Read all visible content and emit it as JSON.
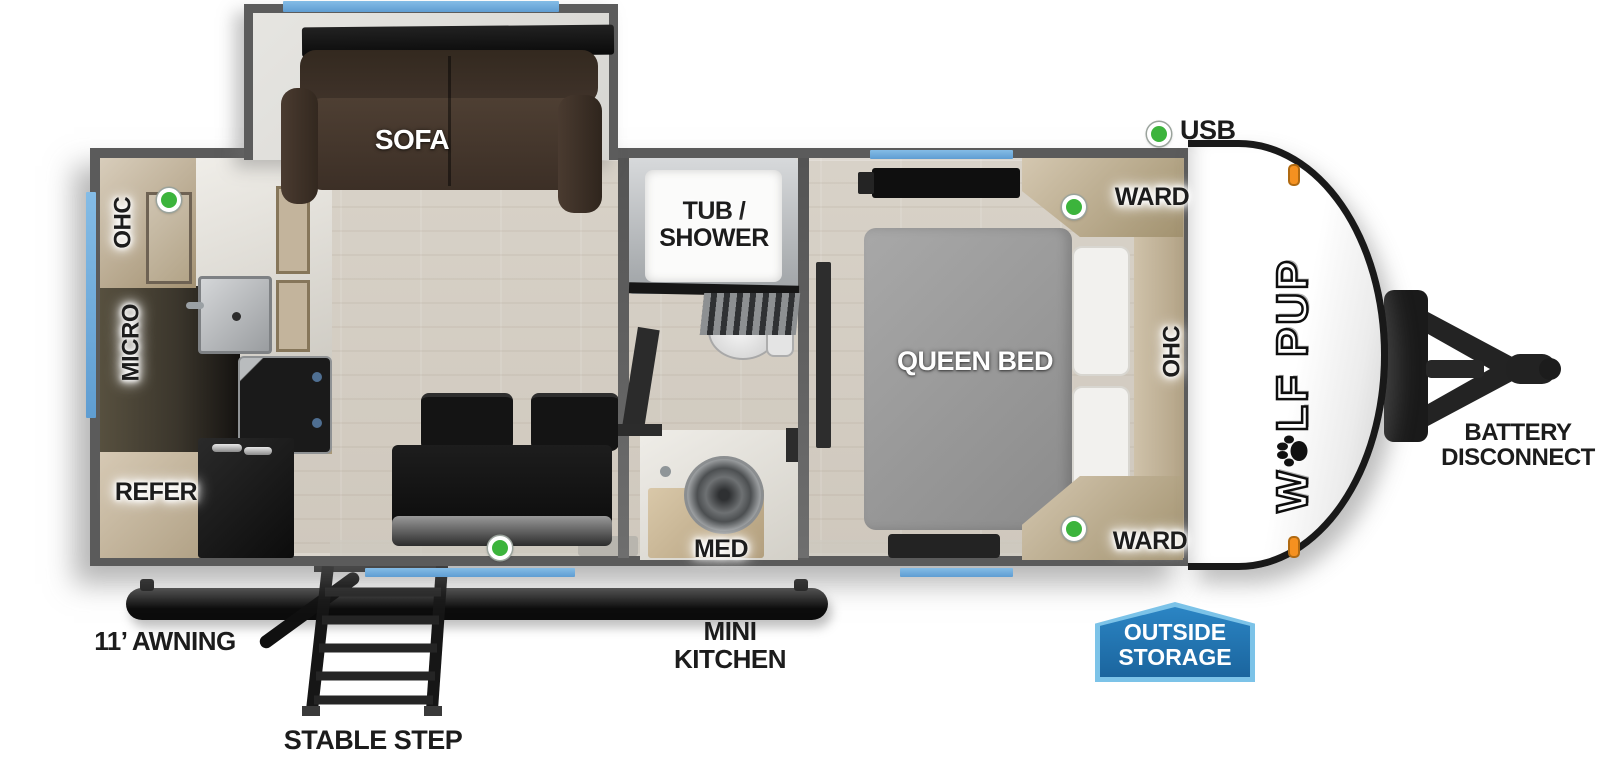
{
  "legend": {
    "usb": "USB"
  },
  "brand": {
    "part1": "W",
    "part2": "LF PUP"
  },
  "rooms": {
    "living": {
      "sofa": "SOFA"
    },
    "kitchen": {
      "ohc": "OHC",
      "micro": "MICRO",
      "refer": "REFER"
    },
    "bath": {
      "tub_shower": "TUB /\nSHOWER",
      "med": "MED"
    },
    "bedroom": {
      "queen_bed": "QUEEN BED",
      "ward_top": "WARD",
      "ward_bottom": "WARD",
      "ohc": "OHC"
    }
  },
  "exterior": {
    "awning": "11’ AWNING",
    "stable_step": "STABLE STEP",
    "mini_kitchen": "MINI\nKITCHEN",
    "outside_storage": "OUTSIDE\nSTORAGE",
    "battery_disconnect": "BATTERY\nDISCONNECT"
  },
  "colors": {
    "usb_dot_green": "#3cb43c",
    "window_blue": "#6fa8d8",
    "storage_badge_blue": "#2176b4",
    "storage_badge_border": "#7cc3e8",
    "marker_light_orange": "#f59120",
    "wall_gray": "#5b5b5b"
  }
}
